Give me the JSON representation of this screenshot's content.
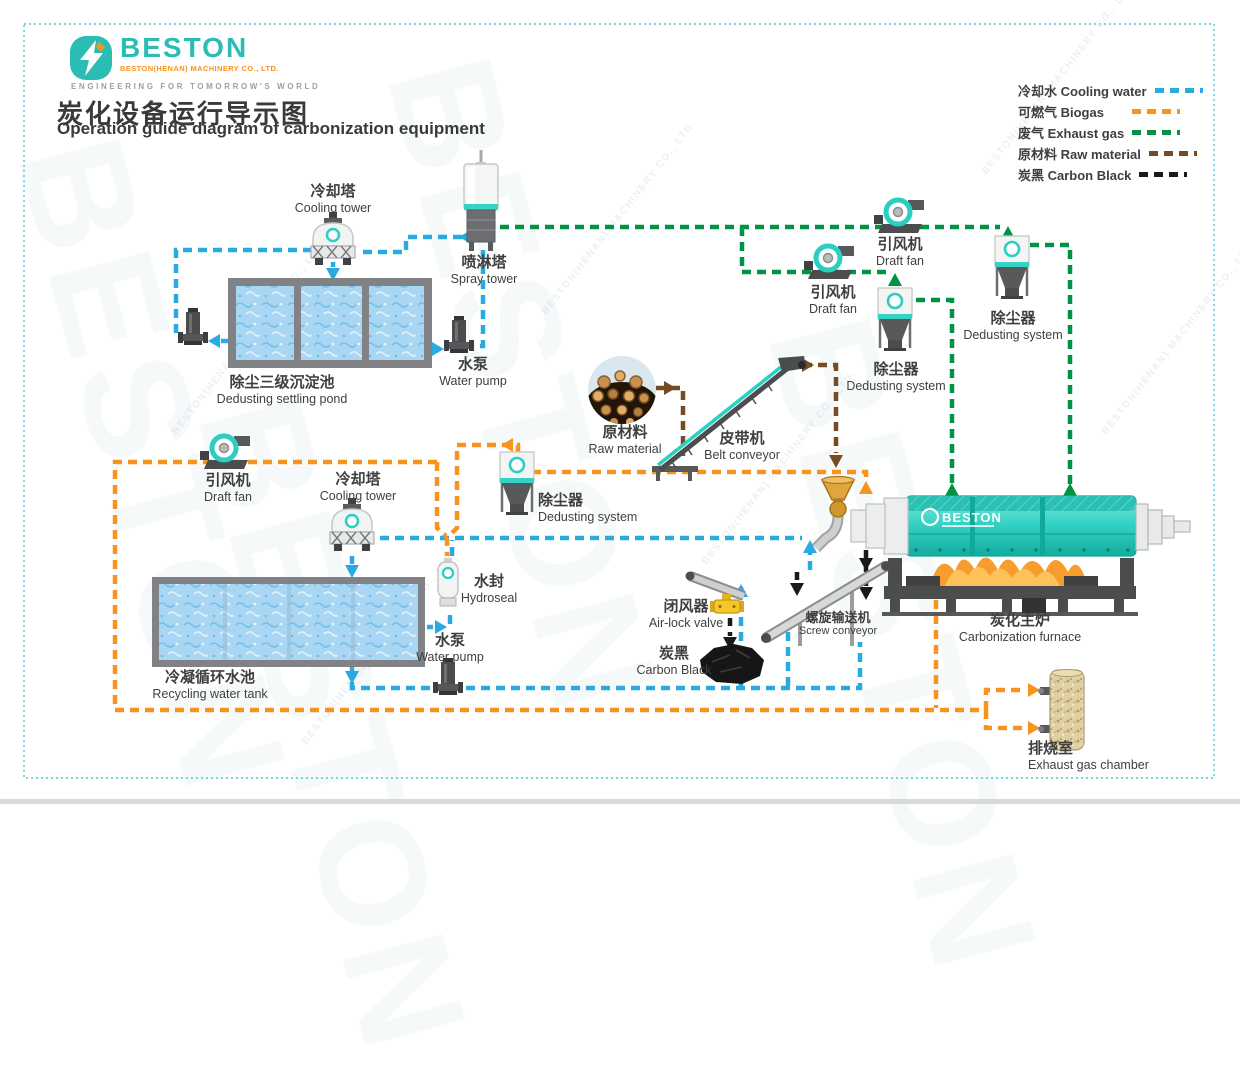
{
  "header": {
    "logo": {
      "brand": "BESTON",
      "company": "BESTON(HENAN) MACHINERY CO., LTD.",
      "tagline": "ENGINEERING FOR TOMORROW'S WORLD"
    },
    "title_zh": "炭化设备运行导示图",
    "title_en": "Operation guide diagram of carbonization equipment"
  },
  "legend": {
    "items": [
      {
        "id": "cooling-water",
        "text": "冷却水 Cooling water",
        "color": "#29ABE2"
      },
      {
        "id": "biogas",
        "text": "可燃气 Biogas",
        "color": "#F7941E"
      },
      {
        "id": "exhaust-gas",
        "text": "废气 Exhaust gas",
        "color": "#009245"
      },
      {
        "id": "raw-material",
        "text": "原材料 Raw material",
        "color": "#754C24"
      },
      {
        "id": "carbon-black",
        "text": "炭黑 Carbon Black",
        "color": "#1A1A1A"
      }
    ]
  },
  "labels": {
    "cooling_tower_1": {
      "zh": "冷却塔",
      "en": "Cooling tower"
    },
    "spray_tower": {
      "zh": "喷淋塔",
      "en": "Spray tower"
    },
    "settling_pond": {
      "zh": "除尘三级沉淀池",
      "en": "Dedusting settling pond"
    },
    "water_pump_top": {
      "zh": "水泵",
      "en": "Water pump"
    },
    "draft_fan_1": {
      "zh": "引风机",
      "en": "Draft fan"
    },
    "draft_fan_2": {
      "zh": "引风机",
      "en": "Draft fan"
    },
    "dedusting_right": {
      "zh": "除尘器",
      "en": "Dedusting system"
    },
    "dedusting_mid": {
      "zh": "除尘器",
      "en": "Dedusting system"
    },
    "raw_material": {
      "zh": "原材料",
      "en": "Raw material"
    },
    "belt_conveyor": {
      "zh": "皮带机",
      "en": "Belt conveyor"
    },
    "draft_fan_3": {
      "zh": "引风机",
      "en": "Draft fan"
    },
    "cooling_tower_2": {
      "zh": "冷却塔",
      "en": "Cooling tower"
    },
    "dedusting_center": {
      "zh": "除尘器",
      "en": "Dedusting system"
    },
    "hydroseal": {
      "zh": "水封",
      "en": "Hydroseal"
    },
    "recycling_tank": {
      "zh": "冷凝循环水池",
      "en": "Recycling water tank"
    },
    "water_pump_bottom": {
      "zh": "水泵",
      "en": "Water pump"
    },
    "air_lock_valve": {
      "zh": "闭风器",
      "en": "Air-lock valve"
    },
    "screw_conveyor": {
      "zh": "螺旋输送机",
      "en": "Screw conveyor"
    },
    "carbon_black": {
      "zh": "炭黑",
      "en": "Carbon Black"
    },
    "furnace": {
      "zh": "炭化主炉",
      "en": "Carbonization furnace"
    },
    "exhaust_chamber": {
      "zh": "排烧室",
      "en": "Exhaust gas chamber"
    }
  },
  "furnace_brand": "BESTON",
  "watermark": {
    "brand": "BESTON",
    "company": "BESTON(HENAN) MACHINERY CO., LTD."
  },
  "colors": {
    "cooling_water": "#29ABE2",
    "biogas": "#F7941E",
    "exhaust_gas": "#009245",
    "raw_material": "#754C24",
    "carbon_black": "#1A1A1A",
    "equipment_teal": "#35D3C5",
    "brand_teal": "#2BBDB3",
    "brand_orange": "#F7941E"
  }
}
